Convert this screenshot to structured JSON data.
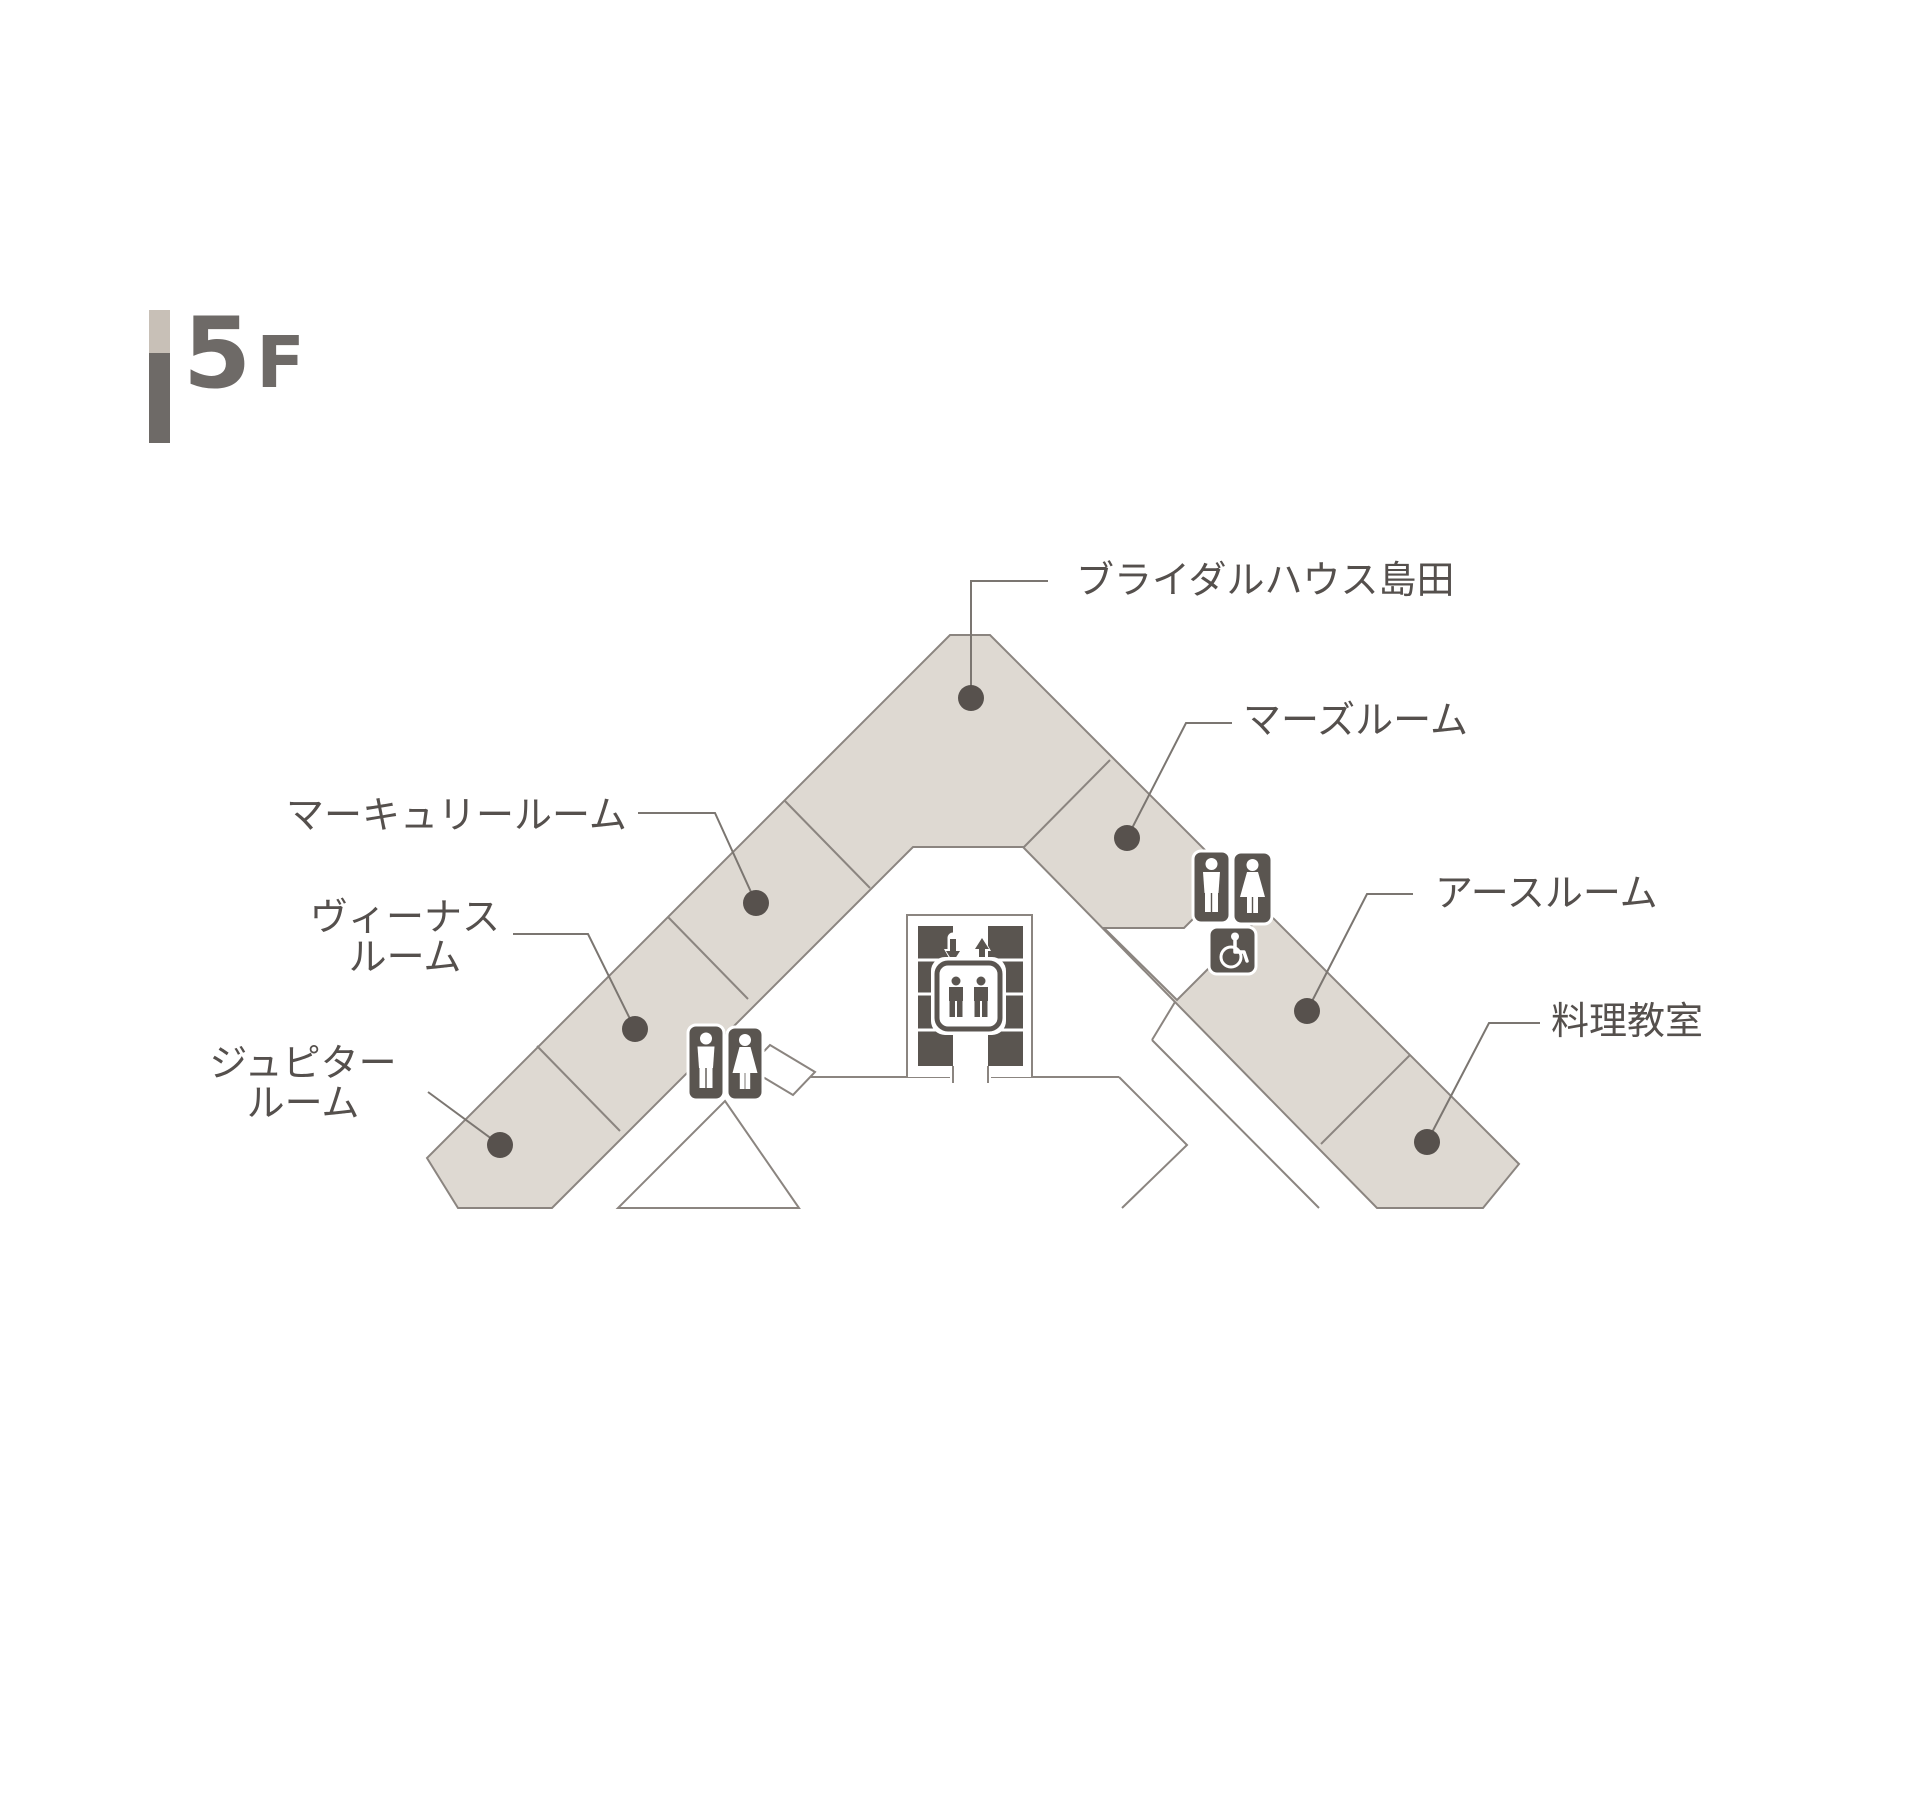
{
  "floor_indicator": {
    "number": "5",
    "suffix": "F"
  },
  "rooms": [
    {
      "id": "bridal-house-shimada",
      "label": "ブライダルハウス島田"
    },
    {
      "id": "mars-room",
      "label": "マーズルーム"
    },
    {
      "id": "mercury-room",
      "label": "マーキュリールーム"
    },
    {
      "id": "venus-room",
      "label": "ヴィーナス\nルーム"
    },
    {
      "id": "jupiter-room",
      "label": "ジュピター\nルーム"
    },
    {
      "id": "earth-room",
      "label": "アースルーム"
    },
    {
      "id": "cooking-classroom",
      "label": "料理教室"
    }
  ],
  "facilities": {
    "elevator": "elevator-icon",
    "elevator_arrows": [
      "down-arrow-icon",
      "up-arrow-icon"
    ],
    "restrooms_center": [
      "male-restroom-icon",
      "female-restroom-icon"
    ],
    "restrooms_east": [
      "male-restroom-icon",
      "female-restroom-icon",
      "wheelchair-accessible-icon"
    ]
  },
  "colors": {
    "bg": "#ffffff",
    "room_fill": "#ded9d2",
    "outline": "#8b8580",
    "leader": "#7b7671",
    "icon_dark": "#5a5550",
    "dot": "#57514d",
    "text": "#55504d",
    "bar_top": "#c8c0b7",
    "bar_bottom": "#6e6a67"
  }
}
